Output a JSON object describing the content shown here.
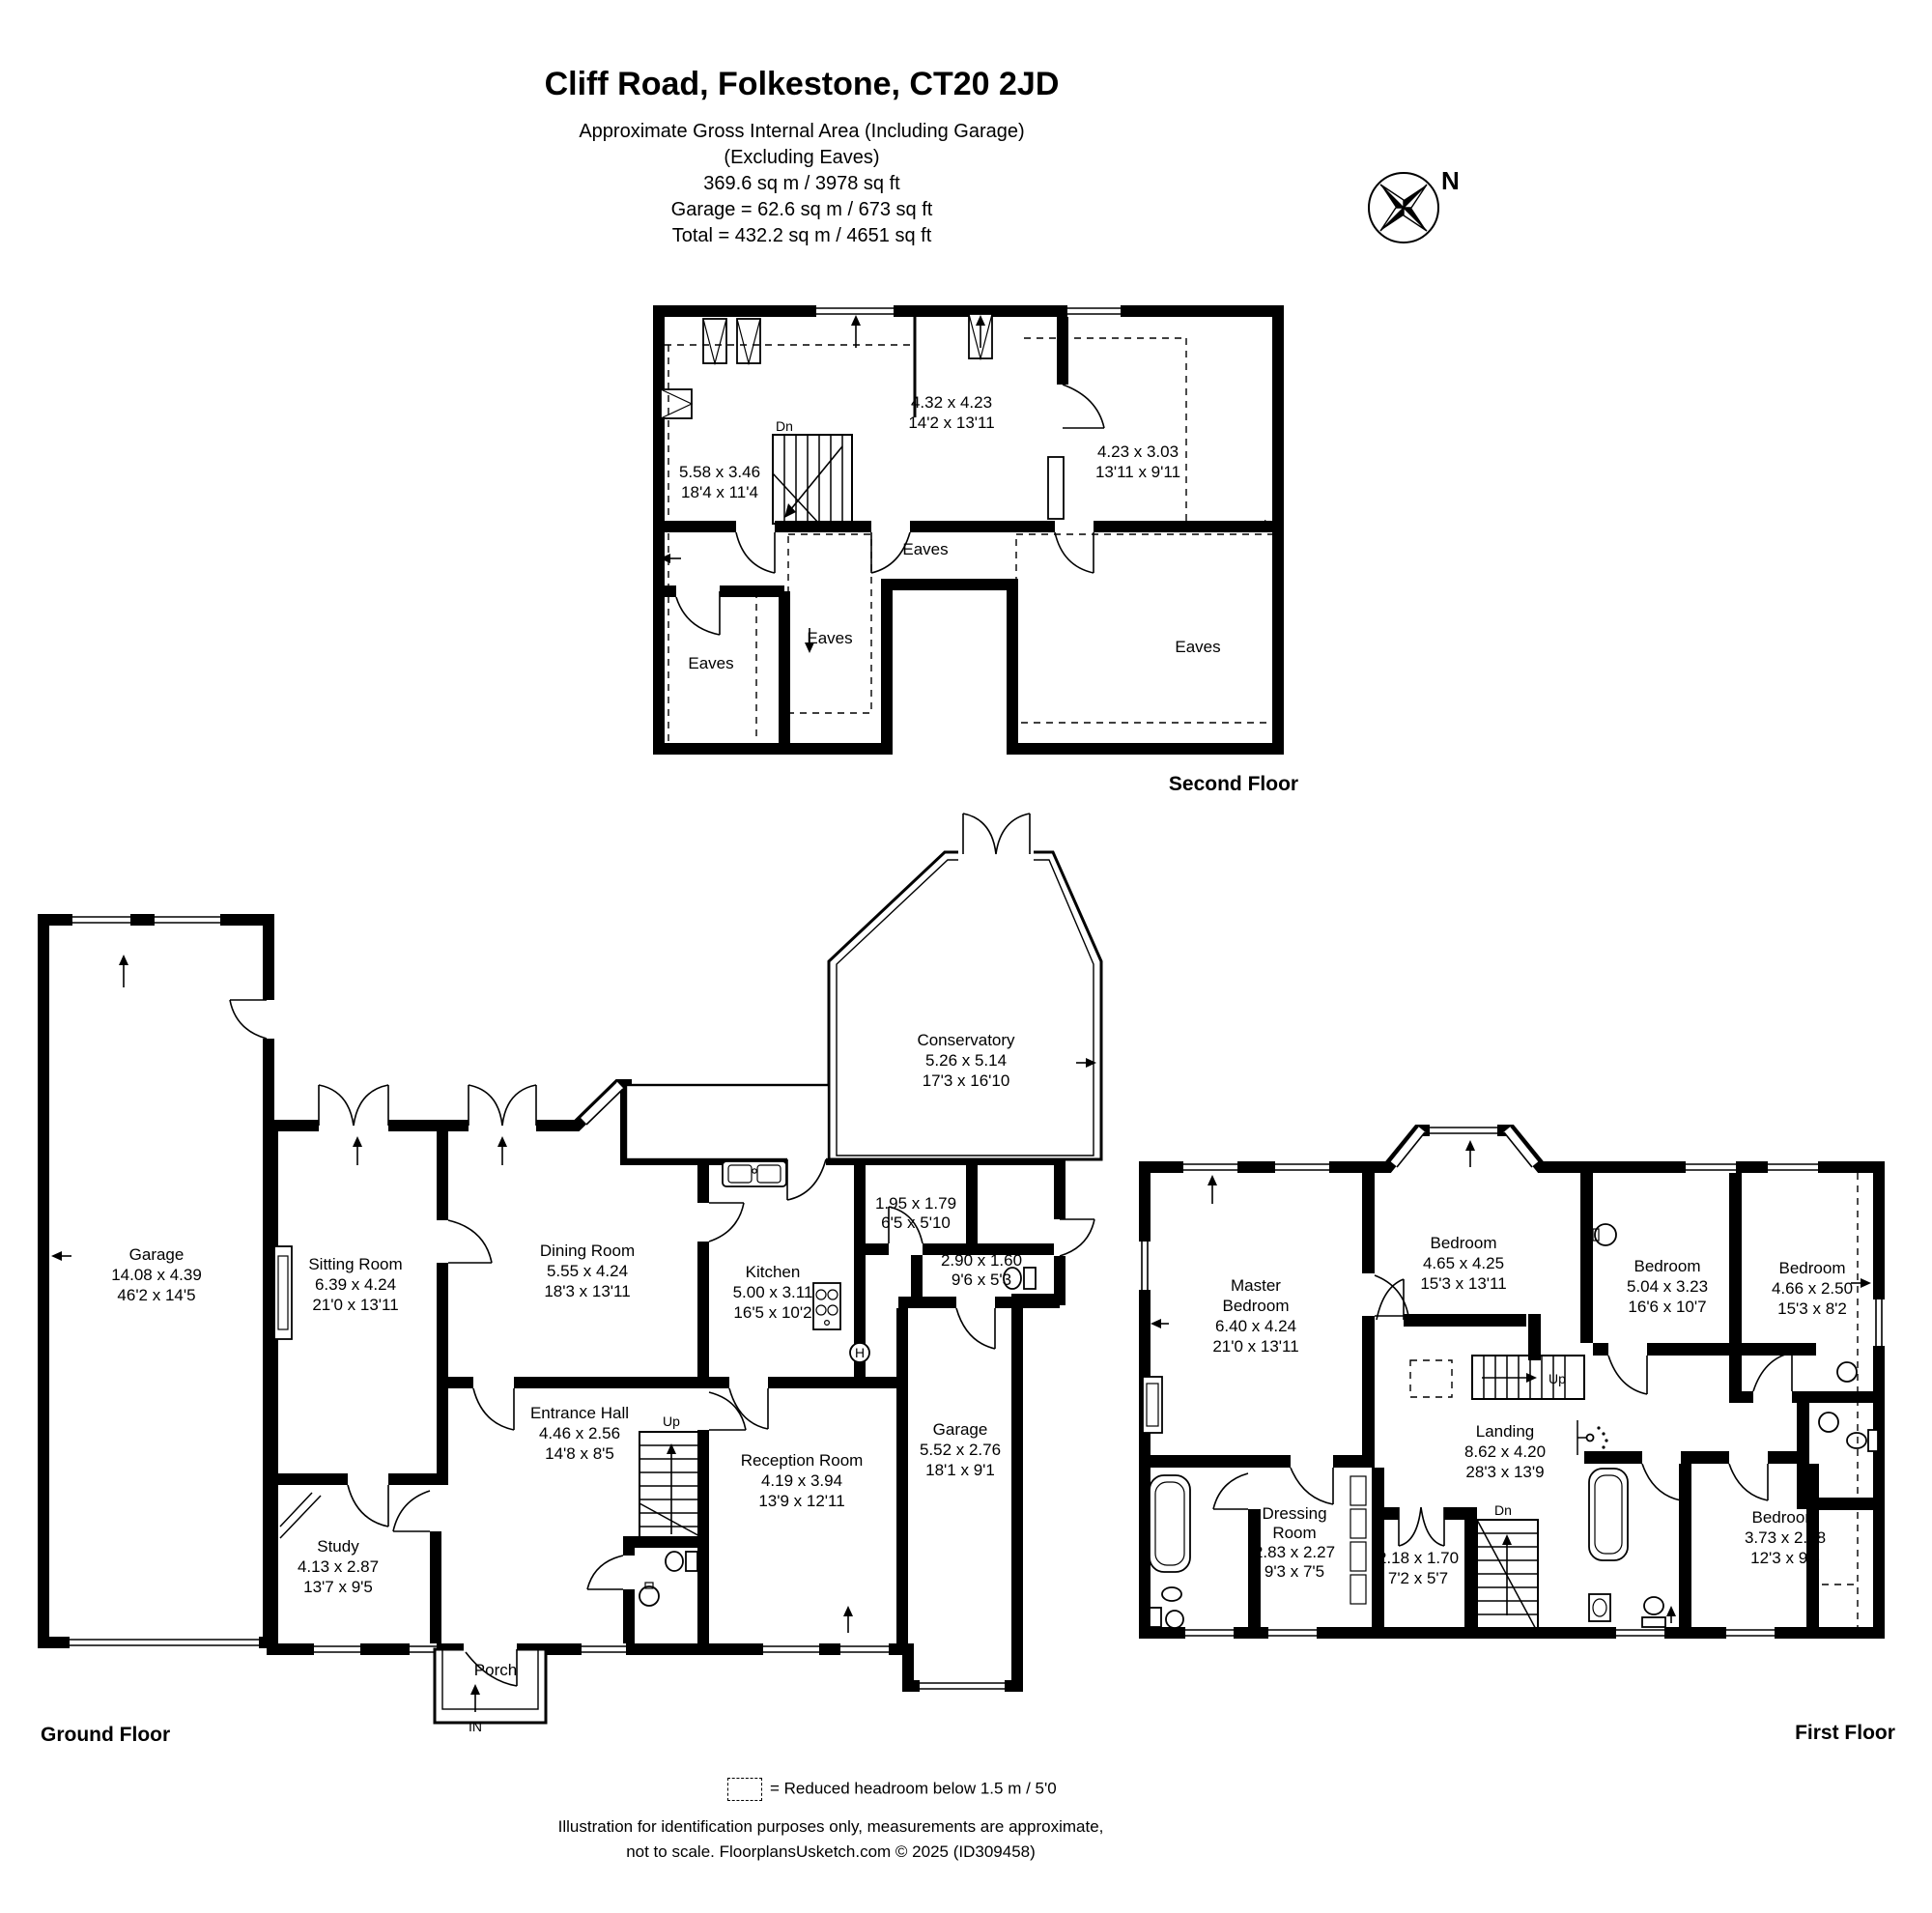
{
  "header": {
    "title": "Cliff Road, Folkestone, CT20 2JD",
    "line1": "Approximate Gross Internal Area (Including Garage)",
    "line2": "(Excluding Eaves)",
    "line3": "369.6 sq m / 3978 sq ft",
    "line4": "Garage = 62.6 sq m / 673 sq ft",
    "line5": "Total = 432.2 sq m / 4651 sq ft",
    "compass_n": "N"
  },
  "second_floor": {
    "floor_label": "Second Floor",
    "room_a_m": "5.58 x 3.46",
    "room_a_ft": "18'4 x 11'4",
    "room_b_m": "4.32 x 4.23",
    "room_b_ft": "14'2 x 13'11",
    "room_c_m": "4.23 x 3.03",
    "room_c_ft": "13'11 x 9'11",
    "stairs_dn": "Dn",
    "eaves1": "Eaves",
    "eaves2": "Eaves",
    "eaves3": "Eaves",
    "eaves4": "Eaves"
  },
  "ground_floor": {
    "floor_label": "Ground Floor",
    "garage_name": "Garage",
    "garage_m": "14.08 x 4.39",
    "garage_ft": "46'2 x 14'5",
    "sitting_name": "Sitting Room",
    "sitting_m": "6.39 x 4.24",
    "sitting_ft": "21'0 x 13'11",
    "dining_name": "Dining Room",
    "dining_m": "5.55 x 4.24",
    "dining_ft": "18'3 x 13'11",
    "kitchen_name": "Kitchen",
    "kitchen_m": "5.00 x 3.11",
    "kitchen_ft": "16'5 x 10'2",
    "conservatory_name": "Conservatory",
    "conservatory_m": "5.26 x 5.14",
    "conservatory_ft": "17'3 x 16'10",
    "utility_m": "1.95 x 1.79",
    "utility_ft": "6'5 x 5'10",
    "lobby_m": "2.90 x 1.60",
    "lobby_ft": "9'6 x 5'3",
    "hall_name": "Entrance Hall",
    "hall_m": "4.46 x 2.56",
    "hall_ft": "14'8 x 8'5",
    "reception_name": "Reception Room",
    "reception_m": "4.19 x 3.94",
    "reception_ft": "13'9 x 12'11",
    "garage2_name": "Garage",
    "garage2_m": "5.52 x 2.76",
    "garage2_ft": "18'1 x 9'1",
    "study_name": "Study",
    "study_m": "4.13 x 2.87",
    "study_ft": "13'7 x 9'5",
    "porch_name": "Porch",
    "stairs_up": "Up",
    "entry": "IN",
    "boiler": "H"
  },
  "first_floor": {
    "floor_label": "First Floor",
    "master_name1": "Master",
    "master_name2": "Bedroom",
    "master_m": "6.40 x 4.24",
    "master_ft": "21'0 x 13'11",
    "bed2_name": "Bedroom",
    "bed2_m": "4.65 x 4.25",
    "bed2_ft": "15'3 x 13'11",
    "bed3_name": "Bedroom",
    "bed3_m": "5.04 x 3.23",
    "bed3_ft": "16'6 x 10'7",
    "bed4_name": "Bedroom",
    "bed4_m": "4.66 x 2.50",
    "bed4_ft": "15'3 x 8'2",
    "bed5_name": "Bedroom",
    "bed5_m": "3.73 x 2.88",
    "bed5_ft": "12'3 x 9'5",
    "landing_name": "Landing",
    "landing_m": "8.62 x 4.20",
    "landing_ft": "28'3 x 13'9",
    "dressing_name1": "Dressing",
    "dressing_name2": "Room",
    "dressing_m": "2.83 x 2.27",
    "dressing_ft": "9'3 x 7'5",
    "cupboard_m": "2.18 x 1.70",
    "cupboard_ft": "7'2 x 5'7",
    "stairs_up": "Up",
    "stairs_dn": "Dn"
  },
  "legend": {
    "text": "=  Reduced headroom below 1.5 m / 5'0"
  },
  "footer": {
    "line1": "Illustration for identification purposes only, measurements are approximate,",
    "line2": "not to scale. FloorplansUsketch.com © 2025 (ID309458)"
  }
}
